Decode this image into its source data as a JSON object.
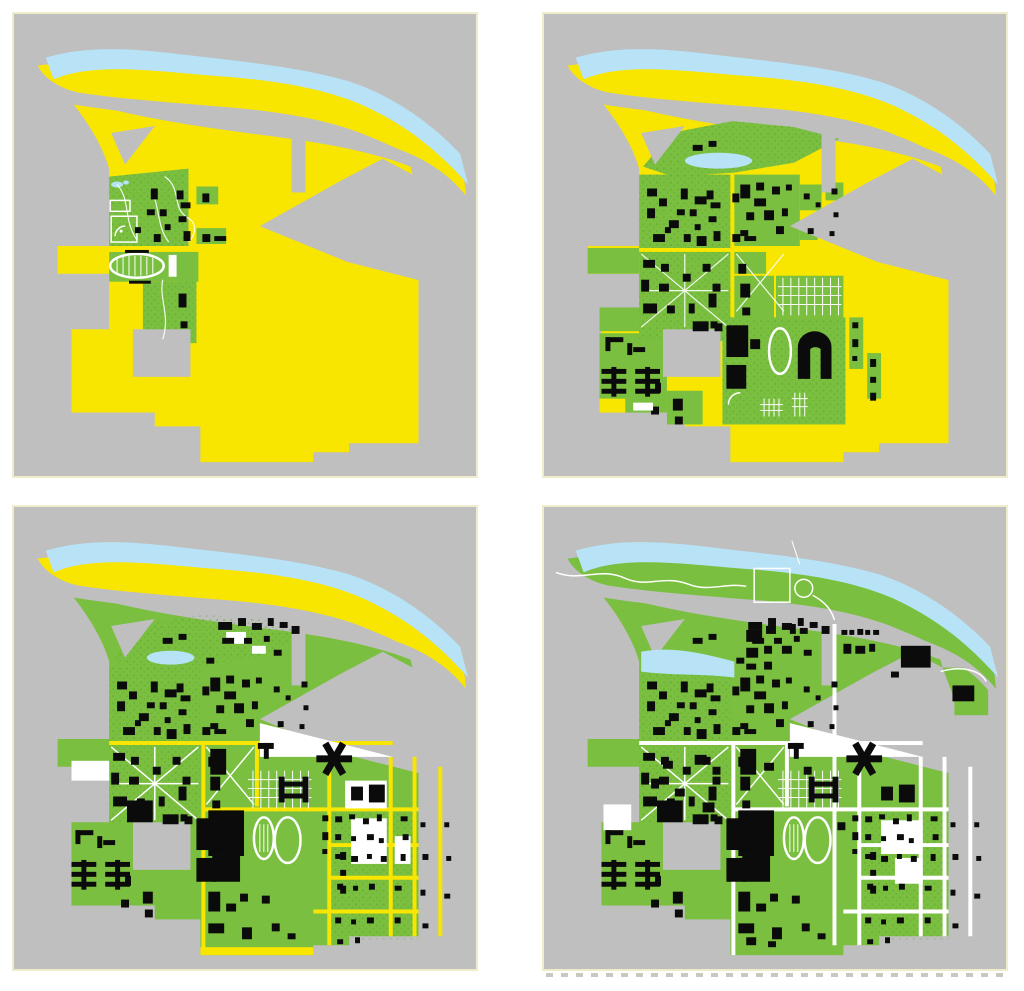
{
  "figure": {
    "kind": "map-series",
    "rows": 2,
    "cols": 2,
    "subject": "campus land development over four stages"
  },
  "colors": {
    "page-bg": "#ffffff",
    "panel-bg": "#bfbfbf",
    "panel-border": "#eeeccb",
    "undeveloped": "#f9e600",
    "developed": "#7abf3f",
    "developed-dark": "#5ca32f",
    "water": "#b8e2f6",
    "building": "#0b0b0b",
    "path-white": "#ffffff",
    "artifact": "#9b9b8b"
  },
  "panels": [
    {
      "id": "stage-1",
      "grid_position": "top-left",
      "features": [
        "river",
        "riverside-strip",
        "undeveloped-campus-land",
        "first-quad",
        "athletic-track",
        "baseball-field",
        "pond",
        "campus-buildings"
      ]
    },
    {
      "id": "stage-2",
      "grid_position": "top-right",
      "features": [
        "river",
        "riverside-strip",
        "wooded-riverbank",
        "expanding-green-campus",
        "horseshoe-stadium",
        "tennis-courts",
        "dormitory-cross-buildings",
        "campus-buildings"
      ]
    },
    {
      "id": "stage-3",
      "grid_position": "bottom-left",
      "features": [
        "river",
        "riverside-strip",
        "street-grid",
        "stadium-complex",
        "running-tracks",
        "parking-lots",
        "quad-paths",
        "campus-buildings"
      ]
    },
    {
      "id": "stage-4",
      "grid_position": "bottom-right",
      "features": [
        "river",
        "riverfront-park",
        "park-field",
        "white-street-grid",
        "fully-developed-campus",
        "stadium-complex",
        "campus-buildings"
      ]
    }
  ]
}
